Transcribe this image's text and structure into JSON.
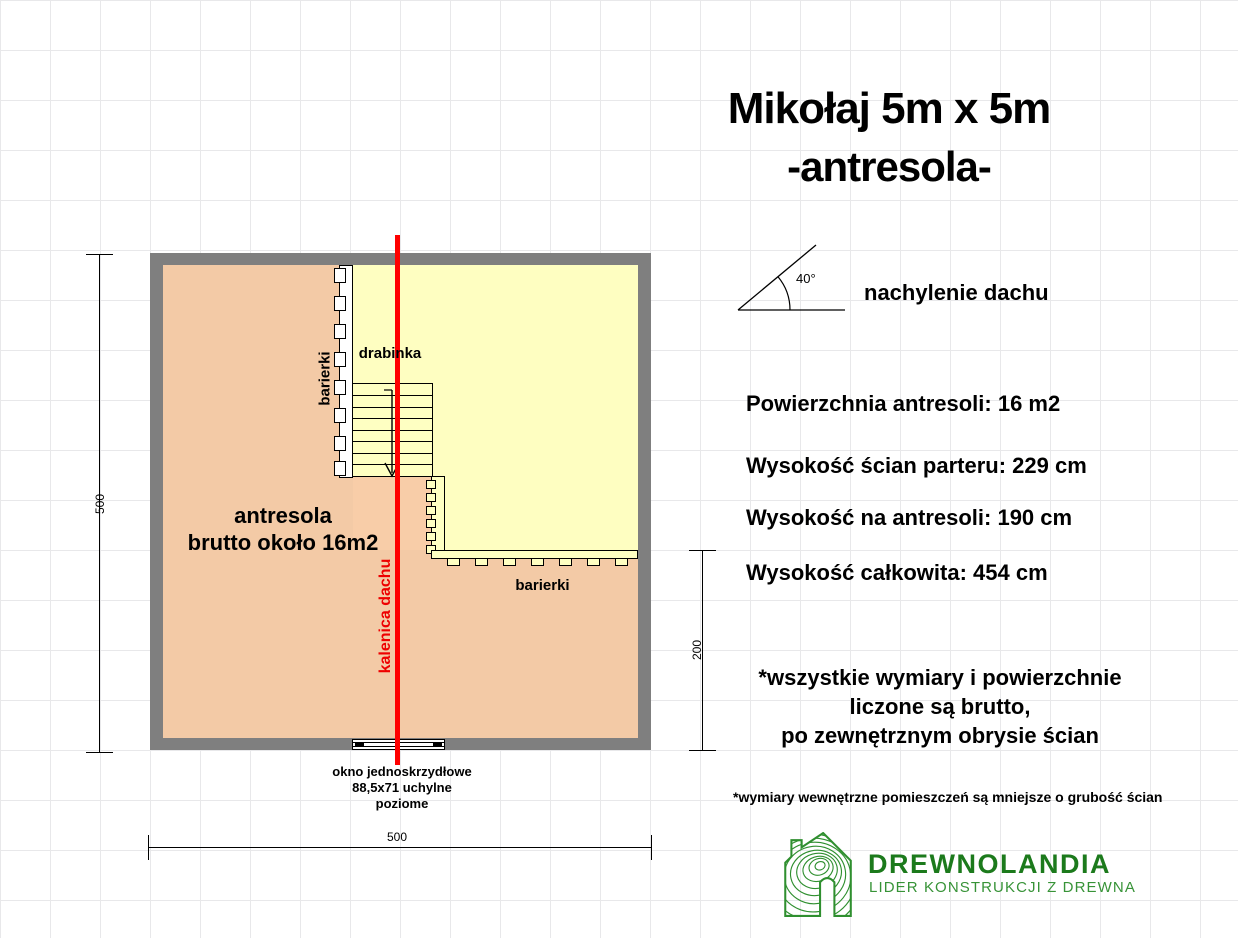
{
  "title": {
    "line1": "Mikołaj 5m x 5m",
    "line2": "-antresola-"
  },
  "roof_pitch": {
    "angle": "40°",
    "caption": "nachylenie dachu"
  },
  "specs": [
    "Powierzchnia antresoli: 16 m2",
    "Wysokość ścian parteru: 229 cm",
    "Wysokość na antresoli: 190 cm",
    "Wysokość całkowita: 454 cm"
  ],
  "footnote": {
    "lines": [
      "*wszystkie wymiary i powierzchnie",
      "liczone są brutto,",
      "po zewnętrznym obrysie ścian"
    ]
  },
  "small_footnote": "*wymiary wewnętrzne pomieszczeń są mniejsze o grubość ścian",
  "logo": {
    "brand": "DREWNOLANDIA",
    "tagline": "LIDER KONSTRUKCJI Z DREWNA"
  },
  "plan": {
    "area_label": {
      "line1": "antresola",
      "line2": "brutto około 16m2"
    },
    "ladder_label": "drabinka",
    "railing_label_left": "barierki",
    "railing_label_bottom": "barierki",
    "ridge_label": "kalenica dachu",
    "window_label": {
      "line1": "okno jednoskrzydłowe",
      "line2": "88,5x71 uchylne",
      "line3": "poziome"
    },
    "dimensions": {
      "left": "500",
      "bottom": "500",
      "right": "200"
    }
  },
  "colors": {
    "wall": "#7f7f7f",
    "floor": "#f8cda8",
    "mezzanine": "#feffc2",
    "ridge": "#ff0000",
    "ridge_text": "#ee0000",
    "grid": "#e8e8ea",
    "brand_green": "#1c7a1c",
    "tagline_green": "#379337"
  }
}
